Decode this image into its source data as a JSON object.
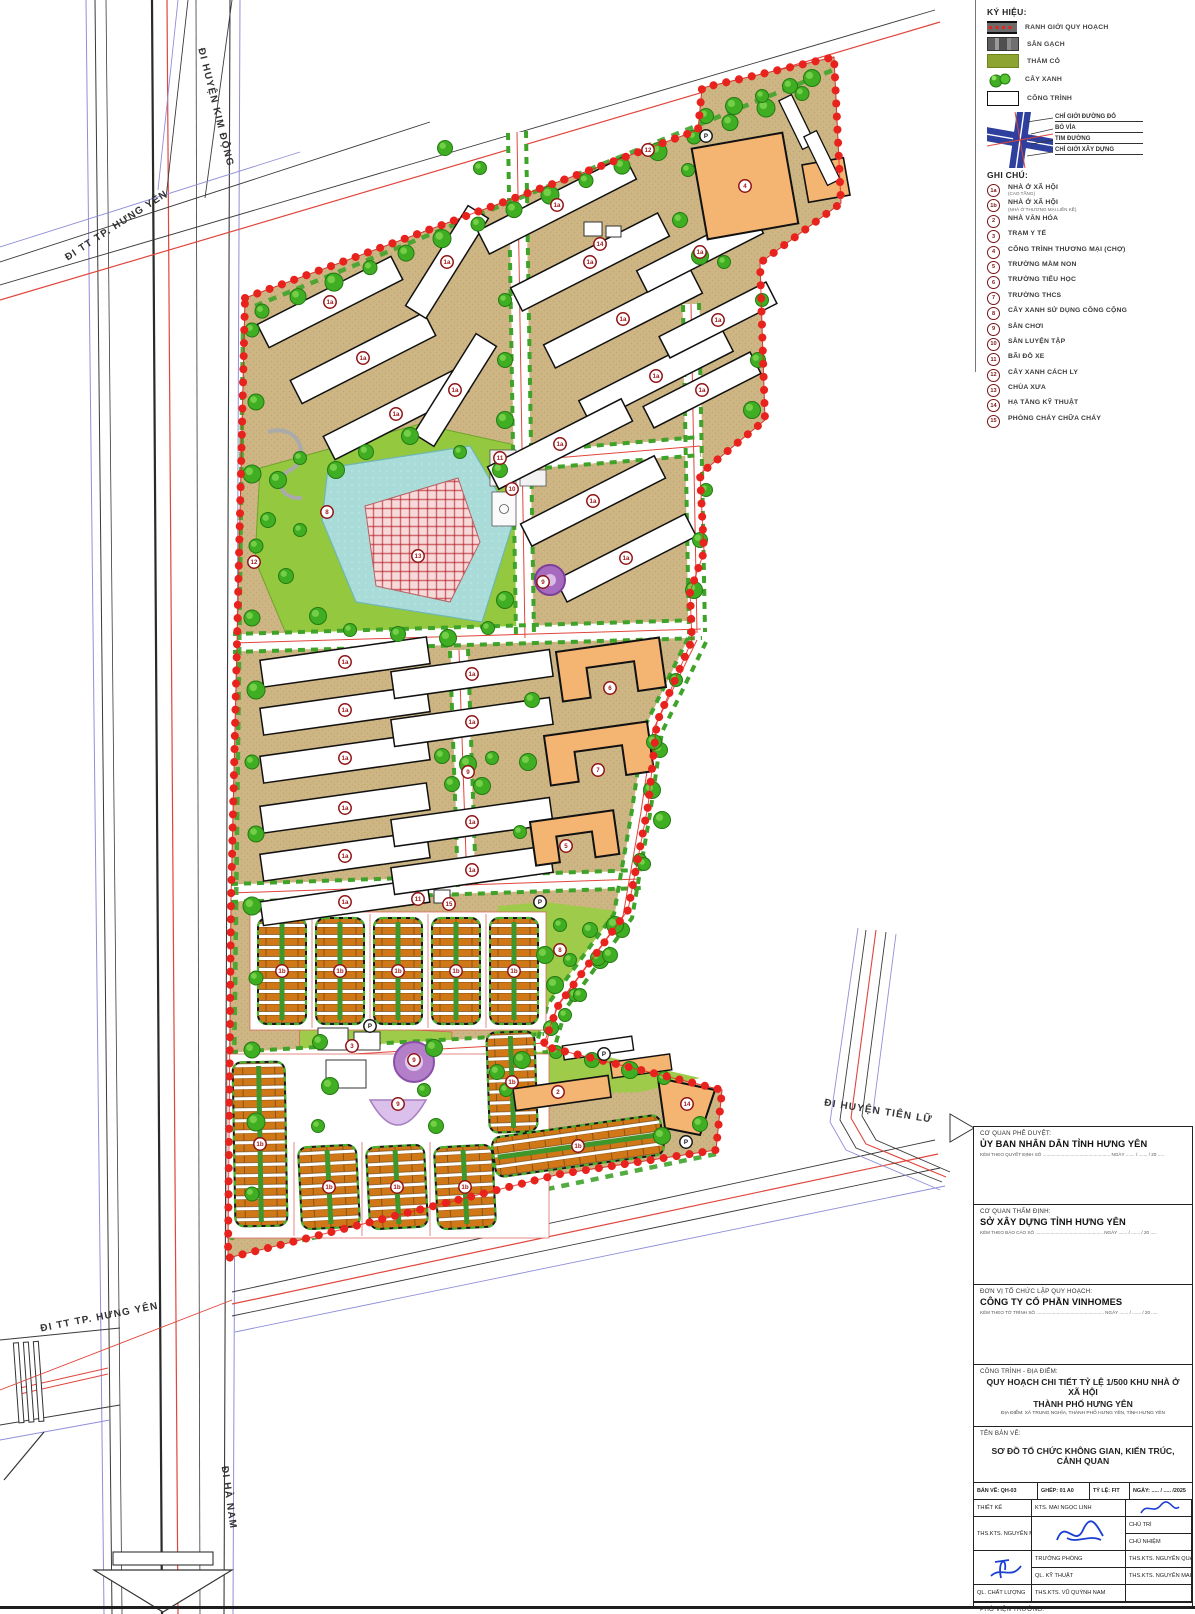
{
  "colors": {
    "boundary_red": "#E8221D",
    "road_red": "#E0463C",
    "road_blue": "#8F8FD8",
    "site_tan": "#CDB584",
    "park_green": "#93C83F",
    "verge_green": "#3FA32A",
    "pond_blue": "#A9DCD8",
    "plaza_pink": "#F6D9D9",
    "rowhouse_orange": "#D07818",
    "school_orange": "#F4B472",
    "marker_red": "#A3191B",
    "badge_maroon": "#7A1315",
    "playground_purple": "#B47FC9",
    "logo_red": "#D6231F"
  },
  "map": {
    "slab_marker": "1a",
    "block_marker": "1b",
    "road_labels": [
      {
        "text": "ĐI HUYỆN KIM ĐỘNG",
        "x": 213,
        "y": 108,
        "r": 76
      },
      {
        "text": "ĐI TT TP. HƯNG YÊN",
        "x": 118,
        "y": 228,
        "r": -33
      },
      {
        "text": "ĐI TT TP. HƯNG YÊN",
        "x": 100,
        "y": 1320,
        "r": -11
      },
      {
        "text": "ĐI HUYỆN TIÊN LỮ",
        "x": 878,
        "y": 1114,
        "r": 9
      },
      {
        "text": "ĐI HÀ NAM",
        "x": 226,
        "y": 1498,
        "r": 82
      }
    ],
    "markers": [
      {
        "t": "12",
        "x": 648,
        "y": 150
      },
      {
        "t": "12",
        "x": 254,
        "y": 562
      },
      {
        "t": "P",
        "x": 706,
        "y": 136,
        "d": 1
      },
      {
        "t": "4",
        "x": 745,
        "y": 186
      },
      {
        "t": "14",
        "x": 600,
        "y": 244
      },
      {
        "t": "14",
        "x": 687,
        "y": 1104
      },
      {
        "t": "11",
        "x": 500,
        "y": 458
      },
      {
        "t": "11",
        "x": 418,
        "y": 899
      },
      {
        "t": "10",
        "x": 512,
        "y": 489
      },
      {
        "t": "8",
        "x": 327,
        "y": 512
      },
      {
        "t": "8",
        "x": 560,
        "y": 950
      },
      {
        "t": "13",
        "x": 418,
        "y": 556
      },
      {
        "t": "9",
        "x": 543,
        "y": 582
      },
      {
        "t": "9",
        "x": 468,
        "y": 772
      },
      {
        "t": "9",
        "x": 414,
        "y": 1060
      },
      {
        "t": "9",
        "x": 398,
        "y": 1104
      },
      {
        "t": "6",
        "x": 610,
        "y": 688
      },
      {
        "t": "7",
        "x": 598,
        "y": 770
      },
      {
        "t": "5",
        "x": 566,
        "y": 846
      },
      {
        "t": "15",
        "x": 449,
        "y": 904
      },
      {
        "t": "3",
        "x": 352,
        "y": 1046
      },
      {
        "t": "2",
        "x": 558,
        "y": 1092
      },
      {
        "t": "P",
        "x": 540,
        "y": 902,
        "d": 1
      },
      {
        "t": "P",
        "x": 370,
        "y": 1026,
        "d": 1
      },
      {
        "t": "P",
        "x": 604,
        "y": 1054,
        "d": 1
      },
      {
        "t": "P",
        "x": 686,
        "y": 1142,
        "d": 1
      }
    ]
  },
  "legend": {
    "title": "KÝ HIỆU:",
    "items": [
      {
        "type": "boundary",
        "label": "RANH GIỚI QUY HOẠCH"
      },
      {
        "type": "brick",
        "label": "SÂN GẠCH"
      },
      {
        "type": "grass",
        "label": "THẢM CỎ"
      },
      {
        "type": "trees",
        "label": "CÂY XANH"
      },
      {
        "type": "building",
        "label": "CÔNG TRÌNH"
      }
    ],
    "cross_labels": [
      "CHỈ GIỚI ĐƯỜNG ĐỎ",
      "BÓ VỈA",
      "TIM ĐƯỜNG",
      "CHỈ GIỚI XÂY DỰNG"
    ]
  },
  "notes": {
    "title": "GHI CHÚ:",
    "items": [
      {
        "badge": "1a",
        "label": "NHÀ Ở XÃ HỘI",
        "sub": "(CAO TẦNG)"
      },
      {
        "badge": "1b",
        "label": "NHÀ Ở XÃ HỘI",
        "sub": "(NHÀ Ở THƯƠNG MẠI LIỀN KỀ)"
      },
      {
        "badge": "2",
        "label": "NHÀ VĂN HÓA"
      },
      {
        "badge": "3",
        "label": "TRẠM Y TẾ"
      },
      {
        "badge": "4",
        "label": "CÔNG TRÌNH THƯƠNG MẠI (CHỢ)"
      },
      {
        "badge": "5",
        "label": "TRƯỜNG MẦM NON"
      },
      {
        "badge": "6",
        "label": "TRƯỜNG TIỂU HỌC"
      },
      {
        "badge": "7",
        "label": "TRƯỜNG THCS"
      },
      {
        "badge": "8",
        "label": "CÂY XANH SỬ DỤNG CÔNG CỘNG"
      },
      {
        "badge": "9",
        "label": "SÂN CHƠI"
      },
      {
        "badge": "10",
        "label": "SÂN LUYỆN TẬP"
      },
      {
        "badge": "11",
        "label": "BÃI ĐỖ XE"
      },
      {
        "badge": "12",
        "label": "CÂY XANH CÁCH LY"
      },
      {
        "badge": "13",
        "label": "CHÙA XƯA"
      },
      {
        "badge": "14",
        "label": "HẠ TẦNG KỸ THUẬT"
      },
      {
        "badge": "15",
        "label": "PHÒNG CHÁY CHỮA CHÁY"
      }
    ]
  },
  "titleblock": {
    "sections": [
      {
        "heading": "CƠ QUAN PHÊ DUYỆT:",
        "name": "ỦY BAN NHÂN DÂN TỈNH HƯNG YÊN",
        "note": "KÈM THEO QUYẾT ĐỊNH SỐ ..................................................... NGÀY ....... / ....... / 20 ....."
      },
      {
        "heading": "CƠ QUAN THẨM ĐỊNH:",
        "name": "SỞ XÂY DỰNG TỈNH HƯNG YÊN",
        "note": "KÈM THEO BÁO CÁO SỐ ..................................................... NGÀY ....... / ....... / 20 ....."
      },
      {
        "heading": "ĐƠN VỊ TỔ CHỨC LẬP QUY HOẠCH:",
        "name": "CÔNG TY CỔ PHẦN VINHOMES",
        "note": "KÈM THEO TỜ TRÌNH SỐ ..................................................... NGÀY ....... / ....... / 20 ....."
      }
    ],
    "project": {
      "heading": "CÔNG TRÌNH - ĐỊA ĐIỂM:",
      "line1": "QUY HOẠCH CHI TIẾT TỶ LỆ 1/500 KHU NHÀ Ở XÃ HỘI",
      "line2": "THÀNH PHỐ HƯNG YÊN",
      "line3": "ĐỊA ĐIỂM: XÃ TRUNG NGHĨA, THÀNH PHỐ HƯNG YÊN, TỈNH HƯNG YÊN"
    },
    "drawing": {
      "heading": "TÊN BẢN VẼ:",
      "name": "SƠ ĐỒ TỔ CHỨC KHÔNG GIAN, KIẾN TRÚC, CẢNH QUAN"
    },
    "meta": [
      "BẢN VẼ:  QH-03",
      "GHÉP:  01 A0",
      "TỶ LỆ:  FIT",
      "NGÀY: ..... / ..... /2025"
    ],
    "staff": [
      {
        "role": "THIẾT KẾ",
        "name": "KTS. MAI NGỌC LINH"
      },
      {
        "role": "CHỦ TRÌ",
        "name": "THS.KTS. NGUYỄN MẠNH CƯỜNG"
      },
      {
        "role": "CHỦ NHIỆM",
        "name": ""
      },
      {
        "role": "TRƯỞNG PHÒNG",
        "name": "THS.KTS. NGUYỄN QUANG HUY"
      },
      {
        "role": "QL. KỸ THUẬT",
        "name": "THS.KTS. NGUYỄN MAI PHƯƠNG"
      },
      {
        "role": "QL. CHẤT LƯỢNG",
        "name": "THS.KTS. VŨ QUỲNH NAM"
      }
    ],
    "deputy": {
      "heading": "PHÓ VIỆN TRƯỞNG:",
      "name": "THS.KTS. NGUYỄN MẠNH CƯỜNG"
    },
    "org": {
      "logo": "UAI",
      "logo_sub": "URBAN-ARCHITECTURE INSTITUTE",
      "name": "VIỆN QUY HOẠCH VÀ KIẾN TRÚC ĐÔ THỊ",
      "address": "TRỤ SỞ : P. 101A1, 55 ĐƯỜNG GIẢI PHÓNG, Q. HAI BÀ TRƯNG, TP. HÀ NỘI",
      "tel": "TEL : 024 3628 4233",
      "fax": "FAX : 024 3628 4231"
    }
  }
}
